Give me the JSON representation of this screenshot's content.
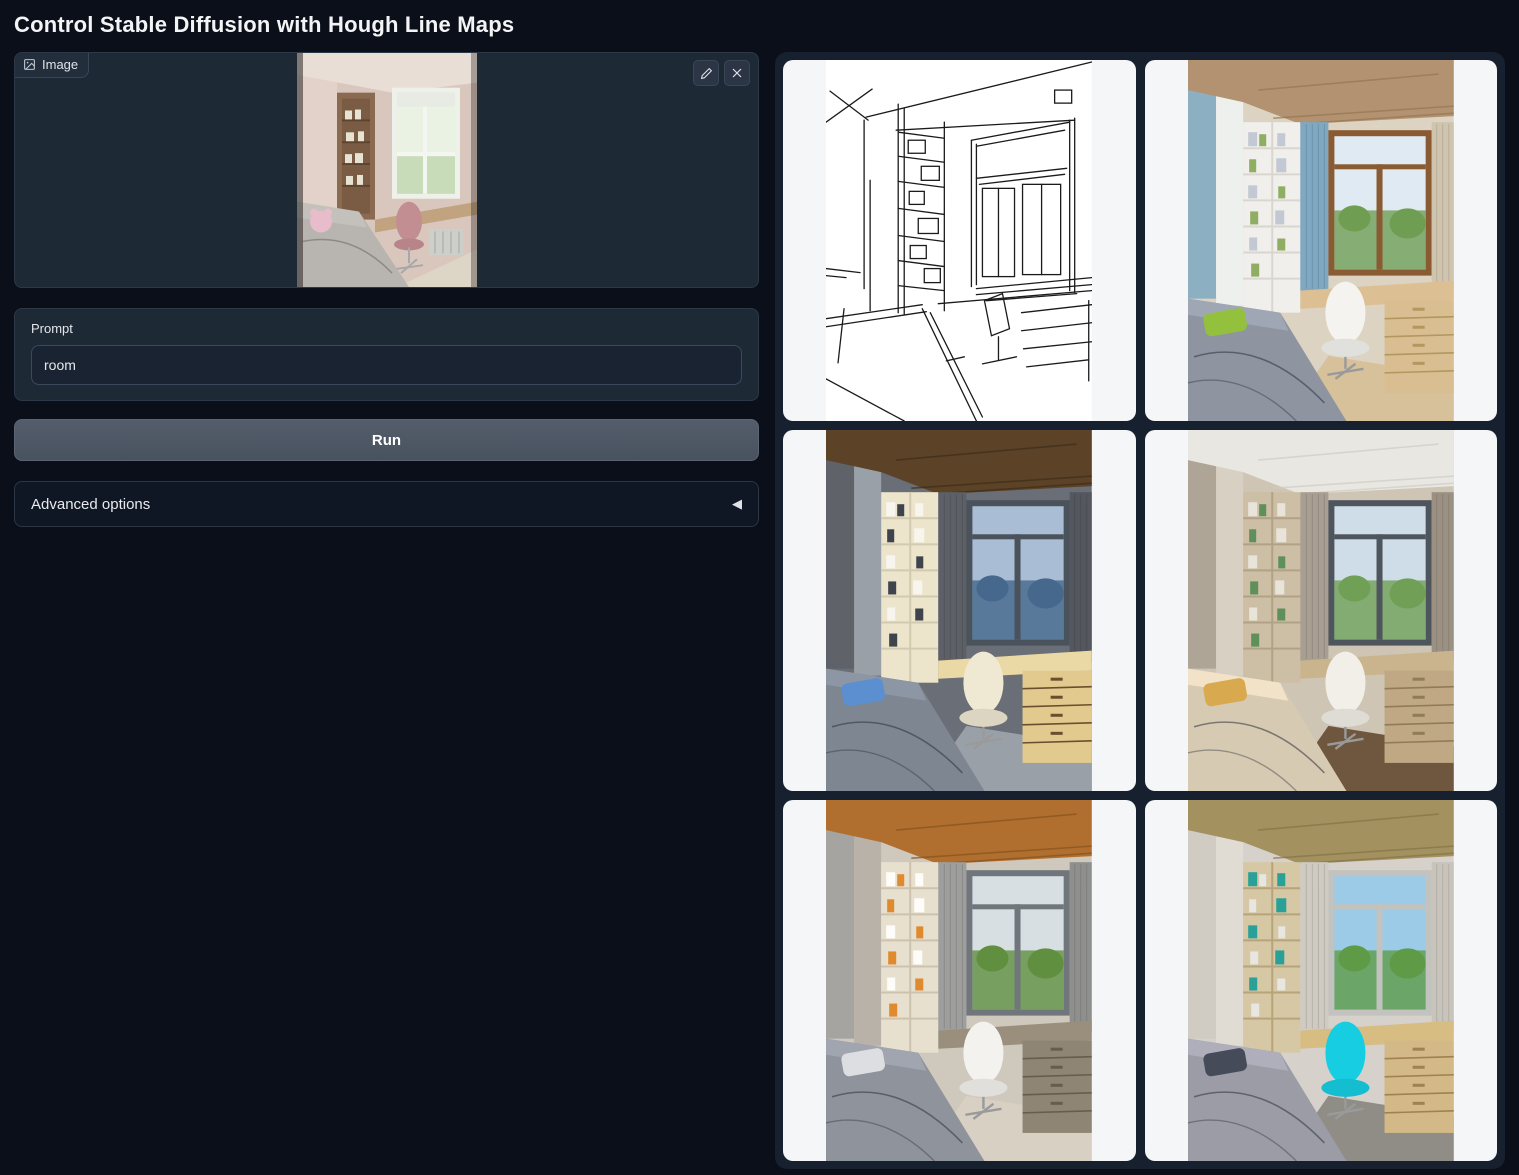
{
  "app": {
    "title": "Control Stable Diffusion with Hough Line Maps"
  },
  "input_image": {
    "label": "Image",
    "icon": "image-icon",
    "edit_icon": "pencil-icon",
    "clear_icon": "close-icon",
    "alt": "Uploaded photo: child's bedroom with wooden bookshelf, bright window, desk with pink chair and gray bed"
  },
  "prompt": {
    "label": "Prompt",
    "value": "room"
  },
  "run_button": {
    "label": "Run"
  },
  "advanced": {
    "label": "Advanced options",
    "collapse_icon": "◀"
  },
  "colors": {
    "page_bg": "#0b0f19",
    "panel_bg": "#1e2936",
    "gallery_bg": "#17202e",
    "card_bg": "#f4f6f8",
    "run_button_bg": "#4e5766"
  },
  "gallery": {
    "items": [
      {
        "type": "line-map",
        "name": "hough-line-map-image",
        "alt": "Hough line map of the room: black line drawing of bookshelf, window, desk, chair and bed on white"
      },
      {
        "type": "photo",
        "name": "generated-image-1",
        "alt": "Generated room: wood ceiling, blue curtains, white shelving, brown-framed window with trees, gray bed with green pillow, white chair",
        "palette": {
          "wall": "#ddd3c2",
          "wallL": "#eef0ee",
          "ceiling": "#b39271",
          "ceilLine": "#97784f",
          "curtain": "#7fa8c2",
          "curtainR": "#cfc4ae",
          "shelf": "#f0efeb",
          "shelfLine": "#d8d6cf",
          "bookA": "#c3c9d2",
          "bookB": "#8fae63",
          "frame": "#8a5a33",
          "sky": "#dfeaf2",
          "view": "#6f9e52",
          "desk": "#dcc094",
          "drawer": "#d9be92",
          "drawerLine": "#b3975f",
          "chair": "#f4f3ef",
          "bed": "#8e95a1",
          "pillow": "#94c13d",
          "floor": "#d6c19b"
        }
      },
      {
        "type": "photo",
        "name": "generated-image-2",
        "alt": "Generated room: dark woven wood ceiling, dark gray curtains, dusk sky window, cream shelving and desk, gray bed with blue pillow",
        "palette": {
          "wall": "#6a6e76",
          "wallL": "#9aa0a8",
          "ceiling": "#5c4226",
          "ceilLine": "#3e2d1a",
          "curtain": "#5d6066",
          "curtainR": "#54575d",
          "shelf": "#ece5cc",
          "shelfLine": "#d2cab0",
          "bookA": "#f7f5ee",
          "bookB": "#3f434b",
          "frame": "#4a525c",
          "sky": "#a9bdd4",
          "view": "#45688c",
          "desk": "#ead9a4",
          "drawer": "#e2c98e",
          "drawerLine": "#6b4e2f",
          "chair": "#efe8d2",
          "bed": "#7e8692",
          "pillow": "#5b8fd0",
          "floor": "#99a0a8"
        }
      },
      {
        "type": "photo",
        "name": "generated-image-3",
        "alt": "Generated room: white ceiling with spotlights, beige walls, window with green trees, tan shelving, white chair, beige bed with mustard pillow, dark wood floor",
        "palette": {
          "wall": "#cfc5b5",
          "wallL": "#d8d0c2",
          "ceiling": "#e9e7e1",
          "ceilLine": "#cfccc4",
          "curtain": "#a89f92",
          "curtainR": "#9b9183",
          "shelf": "#cdbfa6",
          "shelfLine": "#b1a286",
          "bookA": "#e8e4da",
          "bookB": "#5f8f5a",
          "frame": "#4e555c",
          "sky": "#cfdde8",
          "view": "#6fa055",
          "desk": "#c9b48e",
          "drawer": "#bfa883",
          "drawerLine": "#8f7b58",
          "chair": "#f2efe9",
          "bed": "#d7cab3",
          "pillow": "#d8a94e",
          "floor": "#6e563f"
        }
      },
      {
        "type": "photo",
        "name": "generated-image-4",
        "alt": "Generated room: orange wood plank ceiling, gray curtains, window with greenery, white shelving, white chair, gray patterned bed, pale wood floor",
        "palette": {
          "wall": "#cfc8bc",
          "wallL": "#b8b2a8",
          "ceiling": "#b06f2e",
          "ceilLine": "#86531e",
          "curtain": "#9e9e9c",
          "curtainR": "#8f8f8d",
          "shelf": "#e8e0cf",
          "shelfLine": "#ccc2ad",
          "bookA": "#fdfcf8",
          "bookB": "#e08a2f",
          "frame": "#70767b",
          "sky": "#d8dfe3",
          "view": "#5f8f3f",
          "desk": "#9a8f7d",
          "drawer": "#8f8574",
          "drawerLine": "#675d4d",
          "chair": "#f4f2ee",
          "bed": "#8f939c",
          "pillow": "#dcdee2",
          "floor": "#d8d0c2"
        }
      },
      {
        "type": "photo",
        "name": "generated-image-5",
        "alt": "Generated room: olive textured ceiling, light walls, white-framed window with blue sky and bushes, tan shelving and drawers, bright cyan chair, gray bed",
        "palette": {
          "wall": "#d6d2cb",
          "wallL": "#e0dcd4",
          "ceiling": "#a3915f",
          "ceilLine": "#857547",
          "curtain": "#cfcbc2",
          "curtainR": "#c8c4bb",
          "shelf": "#d6c7a5",
          "shelfLine": "#b7a47b",
          "bookA": "#2aa198",
          "bookB": "#e8e6e0",
          "frame": "#c2c2be",
          "sky": "#9ccbe8",
          "view": "#5f9b47",
          "desk": "#d8bd82",
          "drawer": "#d3b987",
          "drawerLine": "#a0814f",
          "chair": "#17cde2",
          "bed": "#9b9ca6",
          "pillow": "#454b58",
          "floor": "#8f8d86"
        }
      }
    ]
  }
}
